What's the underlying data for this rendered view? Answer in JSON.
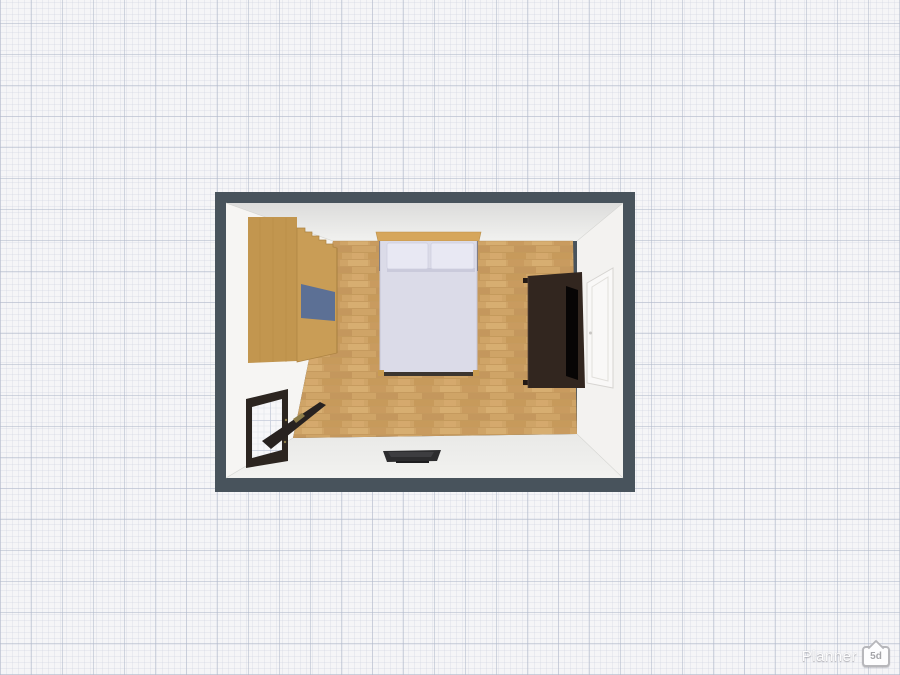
{
  "watermark": {
    "brand": "Planner",
    "badge": "5d"
  },
  "scene": {
    "type": "3d-top-down-floorplan",
    "background": {
      "style": "graph-paper",
      "base": "#f5f5f7",
      "minor_line": "#dde1ea",
      "major_line": "#b9c0d0"
    },
    "room": {
      "name": "bedroom",
      "wall_color": "#48535c",
      "inner_wall_color": "#f3f2f0",
      "floor_color": "#cfa467",
      "objects": [
        {
          "name": "wardrobe",
          "wood_color": "#c49750",
          "panel_color": "#5c7095",
          "position": "top-left-against-wall"
        },
        {
          "name": "double-bed",
          "headboard_color": "#d6a65b",
          "bedding_color": "#dbdbe8",
          "pillow_color": "#e8e8f3",
          "pillows": 2,
          "position": "top-center-against-wall"
        },
        {
          "name": "dresser-with-tv",
          "body_color": "#32261f",
          "screen_color": "#070505",
          "position": "right-against-wall"
        },
        {
          "name": "door-open",
          "frame_color": "#2c2520",
          "handle_color": "#8e7d49",
          "position": "left-wall-lower",
          "state": "open"
        },
        {
          "name": "door-closed",
          "color": "#f9f8f7",
          "outline_color": "#d6d4d1",
          "position": "right-wall",
          "state": "closed"
        },
        {
          "name": "flat-tv",
          "color": "#2c2c2e",
          "position": "bottom-wall-center"
        }
      ]
    }
  }
}
